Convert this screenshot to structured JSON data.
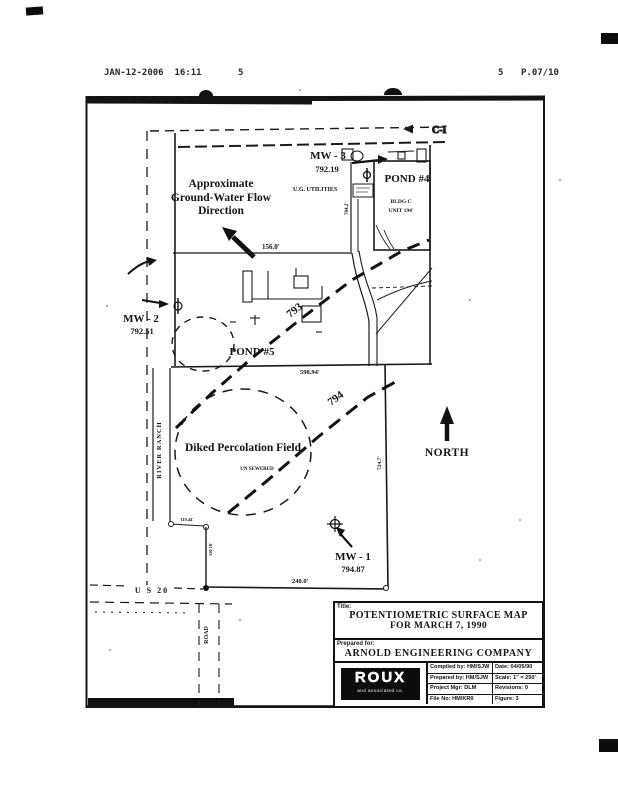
{
  "fax_header": {
    "timestamp": "JAN-12-2006  16:11",
    "code_left": "5",
    "code_right": "5",
    "page": "P.07/10"
  },
  "map": {
    "rail_label": "C-I",
    "flow_label": [
      "Approximate",
      "Ground-Water Flow",
      "Direction"
    ],
    "utilities_label": "U.G. UTILITIES",
    "wells": {
      "mw3": {
        "id": "MW - 3",
        "elev": "792.19"
      },
      "mw2": {
        "id": "MW - 2",
        "elev": "792.51"
      },
      "mw1": {
        "id": "MW - 1",
        "elev": "794.87"
      }
    },
    "pond4": {
      "label": "POND #4",
      "bldg": "BLDG C",
      "unit": "UNIT 194'"
    },
    "pond5": {
      "label": "POND #5"
    },
    "contour_793": "793",
    "contour_794": "794",
    "perc_field": {
      "label": "Diked Percolation Field",
      "note": "UN SEWERED"
    },
    "north_label": "NORTH",
    "road_us20": "U S 20",
    "road_road": "ROAD",
    "road_river_ranch": "RIVER RANCH",
    "dims": {
      "top": "156.0'",
      "mid": "598.94'",
      "bottom": "240.0'",
      "left_v": "110.18'",
      "left_h": "119.44'",
      "right_v": "724.7'",
      "wall": "784.2'"
    }
  },
  "title_block": {
    "title_label": "Title:",
    "title_line1": "POTENTIOMETRIC SURFACE MAP",
    "title_line2": "FOR MARCH 7, 1990",
    "prepared_for_label": "Prepared for:",
    "company": "ARNOLD ENGINEERING COMPANY",
    "logo": "ROUX",
    "logo_sub": "and associated co.",
    "rows": [
      {
        "left": "Compiled by: HM/SJW",
        "right": "Date: 04/05/90"
      },
      {
        "left": "Prepared by: HM/SJW",
        "right": "Scale: 1\" = 250'"
      },
      {
        "left": "Project Mgr: DLM",
        "right": "Revisions: 0"
      },
      {
        "left": "File No: HM/KRII",
        "right": "Figure: 3"
      }
    ]
  }
}
